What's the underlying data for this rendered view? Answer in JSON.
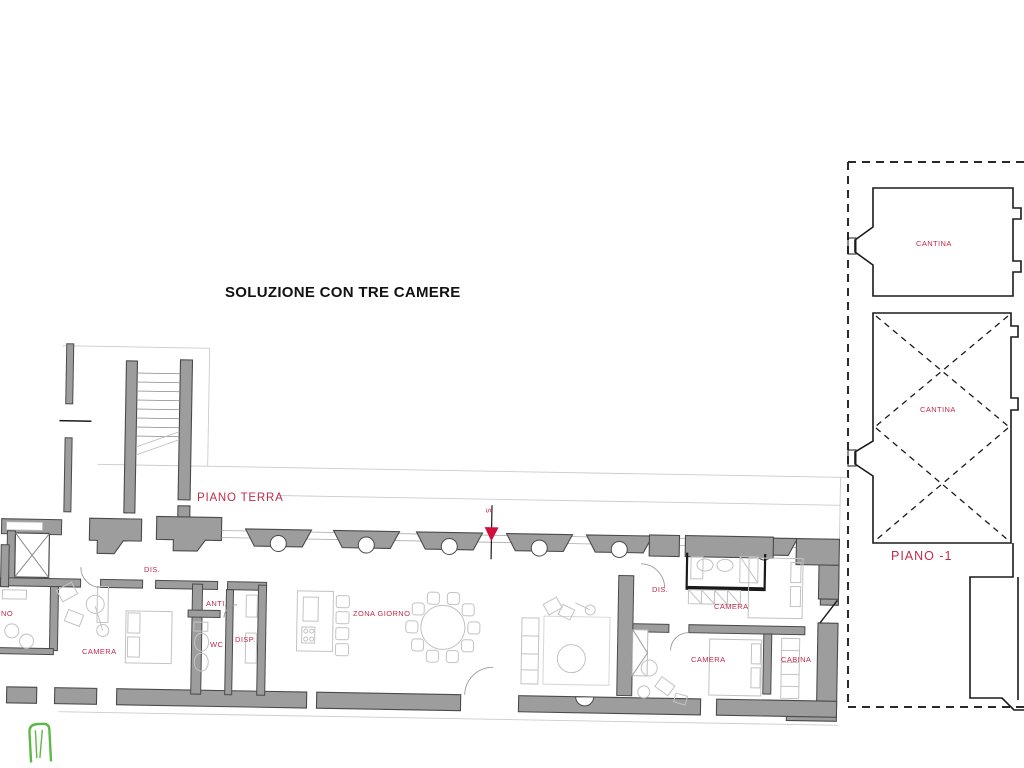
{
  "title": "SOLUZIONE CON TRE CAMERE",
  "ground_floor": {
    "floor_label": "PIANO TERRA",
    "section_marker_letter": "S",
    "rooms": {
      "dis_left": "DIS.",
      "bagno_partial": "NO",
      "camera_left": "CAMERA",
      "anti": "ANTI.",
      "wc": "WC",
      "disp": "DISP.",
      "zona_giorno": "ZONA GIORNO",
      "dis_right": "DIS.",
      "camera_top_right": "CAMERA",
      "camera_bottom_right": "CAMERA",
      "cabina": "CABINA"
    }
  },
  "basement": {
    "floor_label": "PIANO -1",
    "rooms": {
      "cantina_top": "CANTINA",
      "cantina_bottom": "CANTINA"
    }
  },
  "colors": {
    "label_red": "#c22a4a",
    "marker_red": "#d10f3f",
    "wall_fill": "#9d9d9d",
    "wall_outline": "#4a4a4a",
    "line_black": "#1a1a1a",
    "furniture_line": "#c3c3c3",
    "guide_line": "#cccccc",
    "logo_green": "#5cb947"
  }
}
